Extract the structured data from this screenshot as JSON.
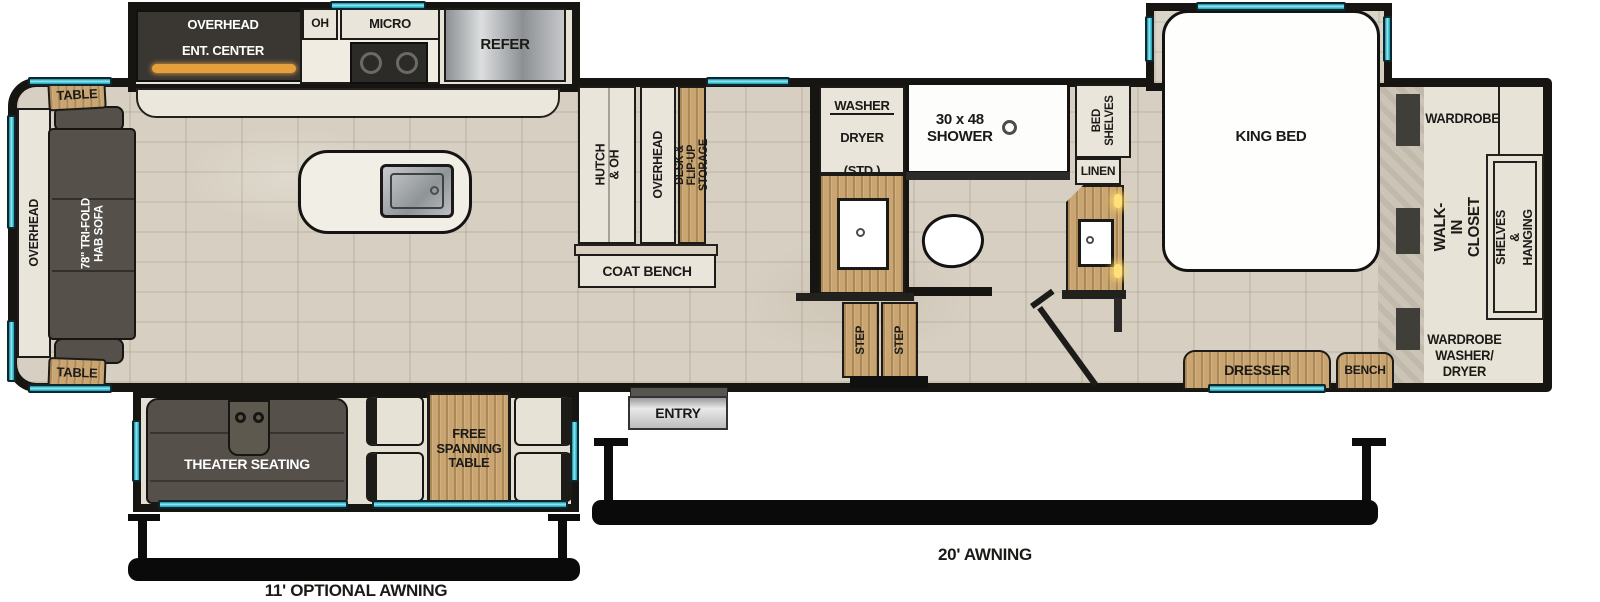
{
  "colors": {
    "wall": "#171512",
    "floor": "#d7d0c2",
    "window": "#35c3d8",
    "wood": "#c9a572",
    "sofa": "#55514a",
    "cabinet": "#eae5da",
    "fireplace": "#e59f3d"
  },
  "rear_lounge": {
    "overhead": "OVERHEAD",
    "sofa": "78\" TRI-FOLD HAB SOFA",
    "table_top": "TABLE",
    "table_bottom": "TABLE"
  },
  "kitchen": {
    "overhead": "OVERHEAD",
    "ent_center": "ENT. CENTER",
    "oh": "OH",
    "micro": "MICRO",
    "refer": "REFER"
  },
  "desk_area": {
    "hutch": "HUTCH & OH",
    "overhead": "OVERHEAD",
    "storage": "DESK & FLIP-UP STORAGE",
    "coat_bench": "COAT BENCH"
  },
  "bathroom": {
    "washer_dryer": [
      "WASHER",
      "DRYER",
      "(STD.)"
    ],
    "shower": "30 x 48\nSHOWER",
    "steps": [
      "STEP",
      "STEP"
    ]
  },
  "bedroom": {
    "bed_shelves": "BED\nSHELVES",
    "linen": "LINEN",
    "king_bed": "KING BED",
    "dresser": "DRESSER",
    "bench": "BENCH"
  },
  "closet": {
    "wardrobe": "WARDROBE",
    "walk_in": "WALK-IN CLOSET",
    "shelves_hanging": "SHELVES & HANGING",
    "washer_dryer": "WARDROBE\nWASHER/\nDRYER"
  },
  "living_slide": {
    "theater": "THEATER SEATING",
    "table": "FREE\nSPANNING\nTABLE"
  },
  "entry": {
    "label": "ENTRY"
  },
  "awnings": {
    "main": "20' AWNING",
    "optional": "11' OPTIONAL AWNING"
  }
}
